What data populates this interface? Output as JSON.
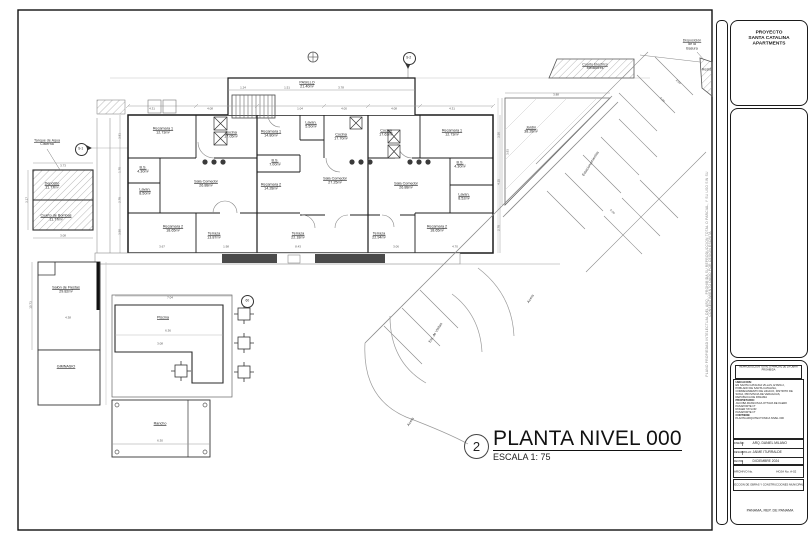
{
  "sheet": {
    "project_panel": {
      "line1": "PROYECTO",
      "line2": "SANTA CATALINA",
      "line3": "APARTMENTS"
    },
    "side_note": "PLANO PROPIEDAD INTELECTUAL DEL ARQ. - PROHIBIDA SU REPRODUCCION TOTAL O PARCIAL, Y SU USO SIN SU CONSENTIMIENTO DADO POR CESION ESCRITA",
    "titleblock": {
      "notice_line1": "REPRODUCCION TOTAL O PARCIAL DE LA OBRA",
      "notice_line2": "PROHIBIDA",
      "ubicacion_label": "UBICACION:",
      "ubicacion_1": "EN SANTA CATALINA VILLAS, ETAPA 2,",
      "ubicacion_2": "POBLADO DE SANTA CATALINA,",
      "ubicacion_3": "CORREGIMIENTO DE HICACO, DISTRITO DE",
      "ubicacion_4": "SONA, PROVINCIA DE VERAGUAS,",
      "ubicacion_5": "REPUBLICA DE PANAMA",
      "propietario_label": "PROPIETARIO:",
      "propietario_1": "JACOBA FRANCISCA OTTAVA DE KLERK",
      "propietario_2": "PASAPORTE N°",
      "propietario_3": "ROGER TAYLOR",
      "propietario_4": "PASAPORTE N°",
      "contiene_label": "CONTIENE:",
      "contiene_value": "PLANTA ARQUITECTONICA NIVEL 000",
      "row1_label": "DISEÑO:",
      "row1_value": "ARQ. DANIEL MILANO",
      "row2_label": "DESARROLLO:",
      "row2_value": "JAIME ITURRALDE",
      "row3_label": "FECHA:",
      "row3_value": "DICIEMBRE 2024",
      "hoja_label": "HOJA No.",
      "hoja_number": "02",
      "archivo_label": "ARCHIVO No.",
      "archivo_hoja": "HOJA No. A-02",
      "direccion": "DIRECCION DE OBRAS Y CONSTRUCCIONES MUNICIPALES",
      "footer": "PANAMA, REP. DE PANAMA"
    }
  },
  "plan": {
    "title": {
      "number": "2",
      "name": "PLANTA NIVEL 000",
      "scale": "ESCALA 1: 75"
    },
    "markers": {
      "s1": "S-1",
      "s2": "S-2",
      "pool_column": "60"
    },
    "rooms": [
      {
        "name": "Recamara 1",
        "area": "12.73m²",
        "x": 163,
        "y": 131
      },
      {
        "name": "Cocina",
        "area": "17.05m²",
        "x": 231,
        "y": 135
      },
      {
        "name": "B.S.",
        "area": "4.30m²",
        "x": 143,
        "y": 170
      },
      {
        "name": "Lavan.",
        "area": "8.50m²",
        "x": 145,
        "y": 192
      },
      {
        "name": "Sala Comedor",
        "area": "26.88m²",
        "x": 206,
        "y": 184
      },
      {
        "name": "Recamara 2",
        "area": "18.65m²",
        "x": 173,
        "y": 229
      },
      {
        "name": "Terraza",
        "area": "13.87m²",
        "x": 214,
        "y": 236
      },
      {
        "name": "PASILLO",
        "area": "21.40m²",
        "x": 307,
        "y": 85
      },
      {
        "name": "Recamara 1",
        "area": "14.80m²",
        "x": 271,
        "y": 134
      },
      {
        "name": "Lavan.",
        "area": "5.50m²",
        "x": 311,
        "y": 125
      },
      {
        "name": "Cocina",
        "area": "17.70m²",
        "x": 341,
        "y": 137
      },
      {
        "name": "B.S.",
        "area": "7.00m²",
        "x": 275,
        "y": 163
      },
      {
        "name": "Recamara 2",
        "area": "14.28m²",
        "x": 271,
        "y": 187
      },
      {
        "name": "Sala Comedor",
        "area": "27.25m²",
        "x": 335,
        "y": 181
      },
      {
        "name": "Terraza",
        "area": "22.18m²",
        "x": 298,
        "y": 236
      },
      {
        "name": "Cocina",
        "area": "17.63m²",
        "x": 386,
        "y": 133
      },
      {
        "name": "Recamara 1",
        "area": "12.73m²",
        "x": 452,
        "y": 133
      },
      {
        "name": "B.S.",
        "area": "4.30m²",
        "x": 460,
        "y": 165
      },
      {
        "name": "Sala Comedor",
        "area": "26.88m²",
        "x": 406,
        "y": 186
      },
      {
        "name": "Lavan.",
        "area": "8.52m²",
        "x": 464,
        "y": 197
      },
      {
        "name": "Recamara 2",
        "area": "18.65m²",
        "x": 437,
        "y": 229
      },
      {
        "name": "Terraza",
        "area": "22.94m²",
        "x": 379,
        "y": 236
      },
      {
        "name": "Depósito",
        "area": "11.77m²",
        "x": 52,
        "y": 186
      },
      {
        "name": "Cuarto de Bombas",
        "area": "11.77m²",
        "x": 56,
        "y": 218
      },
      {
        "name": "Salón de Fiestas",
        "area": "29.82m²",
        "x": 66,
        "y": 290
      },
      {
        "name": "GIMNASIO",
        "area": "",
        "x": 66,
        "y": 367
      },
      {
        "name": "Piscina",
        "area": "",
        "x": 163,
        "y": 318
      },
      {
        "name": "Rancho",
        "area": "",
        "x": 160,
        "y": 424
      },
      {
        "name": "Jardín",
        "area": "38.28m²",
        "x": 531,
        "y": 130
      }
    ],
    "site_labels": [
      {
        "lines": [
          "Tanque de Agua",
          "Cisterna"
        ],
        "x": 47,
        "y": 143,
        "rot": 0,
        "underline": true
      },
      {
        "lines": [
          "Cuarto Electrico",
          "Medidores"
        ],
        "x": 595,
        "y": 67,
        "rot": 0,
        "underline": true
      },
      {
        "lines": [
          "Disposición",
          "de la",
          "Basura"
        ],
        "x": 692,
        "y": 45,
        "rot": 0,
        "underline": true
      },
      {
        "lines": [
          "Resid."
        ],
        "x": 707,
        "y": 70,
        "rot": 0,
        "underline": false
      },
      {
        "lines": [
          "Estacionamientos"
        ],
        "x": 591,
        "y": 164,
        "rot": -58,
        "underline": false
      },
      {
        "lines": [
          "Est. de Visitas"
        ],
        "x": 436,
        "y": 333,
        "rot": -58,
        "underline": false
      },
      {
        "lines": [
          "Acera"
        ],
        "x": 411,
        "y": 422,
        "rot": -58,
        "underline": false
      },
      {
        "lines": [
          "Acera"
        ],
        "x": 531,
        "y": 299,
        "rot": -58,
        "underline": false
      }
    ],
    "dimensions": [
      {
        "v": "4.31",
        "x": 152,
        "y": 109
      },
      {
        "v": "4.08",
        "x": 210,
        "y": 109
      },
      {
        "v": "1.04",
        "x": 300,
        "y": 109
      },
      {
        "v": "4.00",
        "x": 344,
        "y": 109
      },
      {
        "v": "4.08",
        "x": 394,
        "y": 109
      },
      {
        "v": "4.31",
        "x": 452,
        "y": 109
      },
      {
        "v": "1.24",
        "x": 243,
        "y": 88
      },
      {
        "v": "1.51",
        "x": 287,
        "y": 88
      },
      {
        "v": "3.78",
        "x": 341,
        "y": 88
      },
      {
        "v": "3.67",
        "x": 162,
        "y": 247
      },
      {
        "v": "1.98",
        "x": 226,
        "y": 247
      },
      {
        "v": "8.43",
        "x": 298,
        "y": 247
      },
      {
        "v": "3.06",
        "x": 396,
        "y": 247
      },
      {
        "v": "4.70",
        "x": 455,
        "y": 247
      },
      {
        "v": "3.81",
        "x": 120,
        "y": 136,
        "r": -90
      },
      {
        "v": "1.70",
        "x": 120,
        "y": 170,
        "r": -90
      },
      {
        "v": "2.78",
        "x": 120,
        "y": 200,
        "r": -90
      },
      {
        "v": "3.50",
        "x": 120,
        "y": 232,
        "r": -90
      },
      {
        "v": "3.50",
        "x": 499,
        "y": 135,
        "r": -90
      },
      {
        "v": "4.35",
        "x": 499,
        "y": 182,
        "r": -90
      },
      {
        "v": "2.78",
        "x": 499,
        "y": 228,
        "r": -90
      },
      {
        "v": "3.73",
        "x": 63,
        "y": 166
      },
      {
        "v": "3.08",
        "x": 63,
        "y": 236
      },
      {
        "v": "3.17",
        "x": 27,
        "y": 200,
        "r": -90
      },
      {
        "v": "4.38",
        "x": 68,
        "y": 318
      },
      {
        "v": "10.73",
        "x": 31,
        "y": 305,
        "r": -90
      },
      {
        "v": "7.04",
        "x": 170,
        "y": 298
      },
      {
        "v": "6.36",
        "x": 168,
        "y": 331
      },
      {
        "v": "3.08",
        "x": 160,
        "y": 344
      },
      {
        "v": "6.30",
        "x": 160,
        "y": 441
      },
      {
        "v": "3.88",
        "x": 556,
        "y": 95
      },
      {
        "v": "3.93",
        "x": 508,
        "y": 152,
        "r": -90
      },
      {
        "v": "5.00",
        "x": 662,
        "y": 100,
        "r": 45
      },
      {
        "v": "2.50",
        "x": 678,
        "y": 82,
        "r": 45
      },
      {
        "v": "5.00",
        "x": 612,
        "y": 212,
        "r": 45
      }
    ]
  }
}
